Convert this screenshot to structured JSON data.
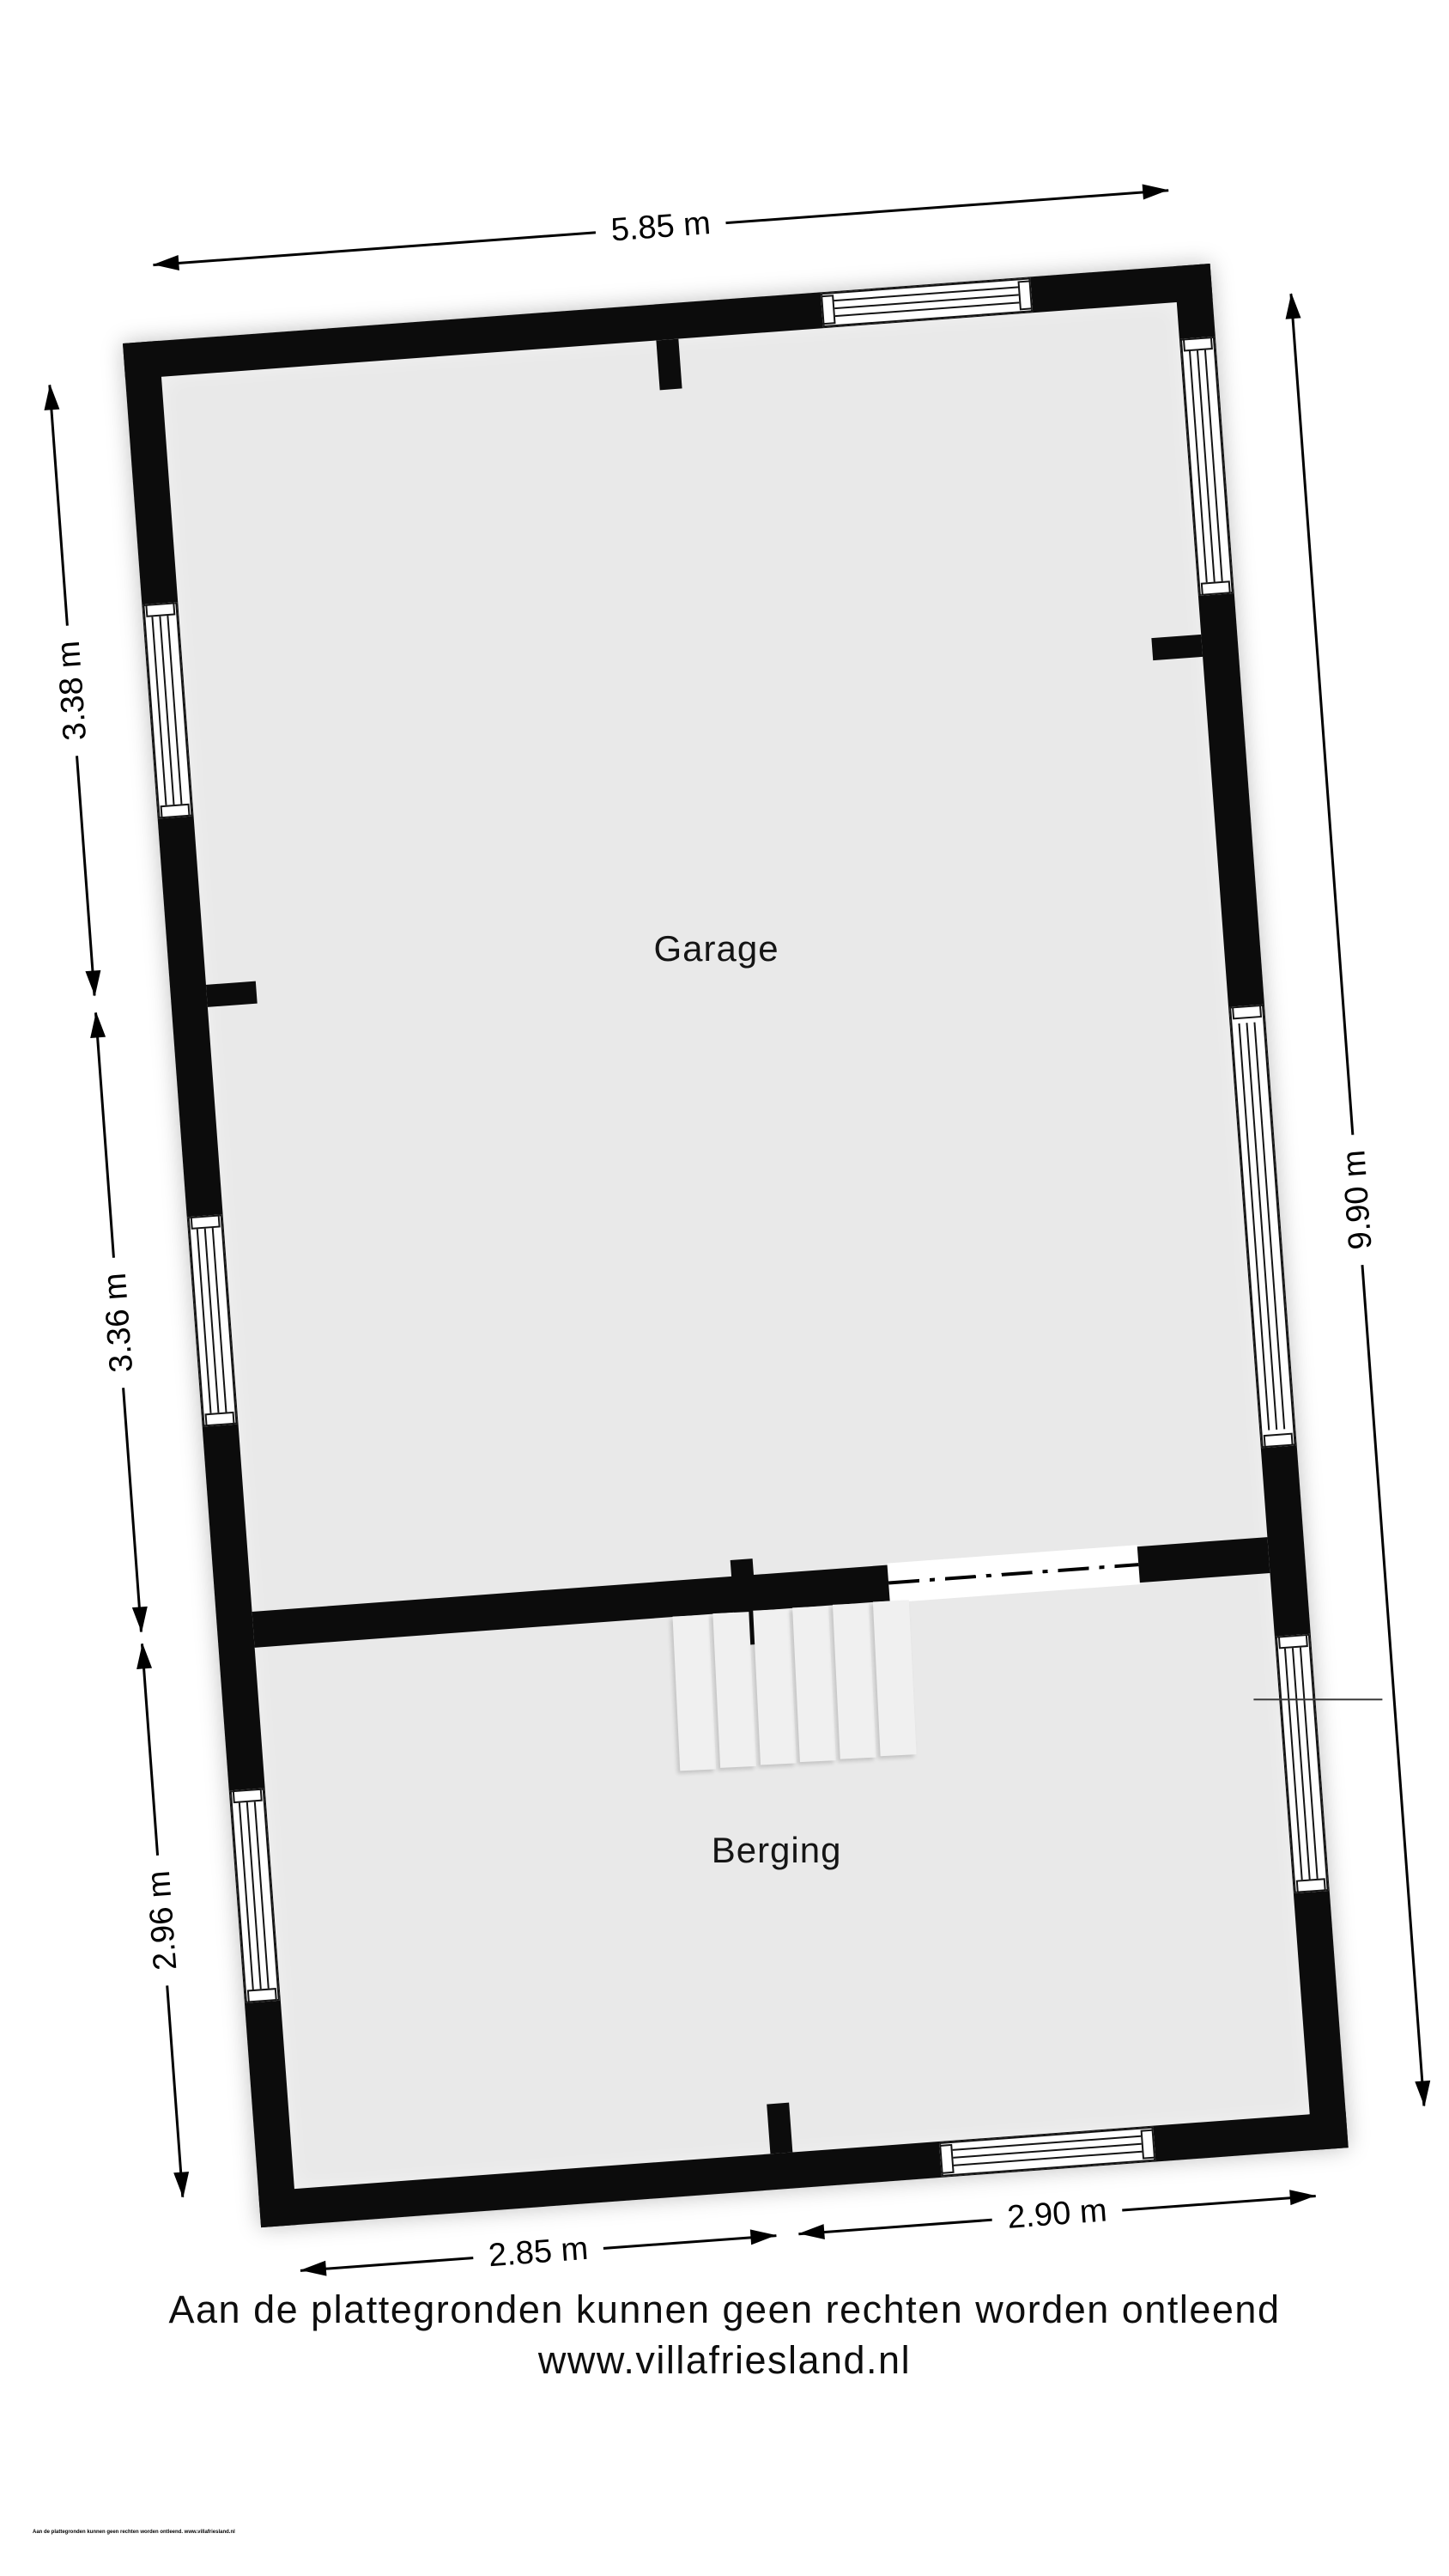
{
  "plan": {
    "rooms": [
      {
        "label": "Garage"
      },
      {
        "label": "Berging"
      }
    ],
    "dims": {
      "top": "5.85 m",
      "left_upper": "3.38 m",
      "left_middle": "3.36 m",
      "left_lower": "2.96 m",
      "right": "9.90 m",
      "bottom_left": "2.85 m",
      "bottom_right": "2.90 m"
    }
  },
  "footer": {
    "disclaimer": "Aan de plattegronden kunnen geen rechten worden ontleend",
    "website": "www.villafriesland.nl",
    "fineprint": "Aan de plattegronden kunnen geen rechten worden ontleend. www.villafriesland.nl"
  },
  "colors": {
    "wall": "#0c0c0c",
    "floor": "#e9e9e9",
    "background": "#ffffff",
    "stair_tread": "#f0f0f0"
  }
}
